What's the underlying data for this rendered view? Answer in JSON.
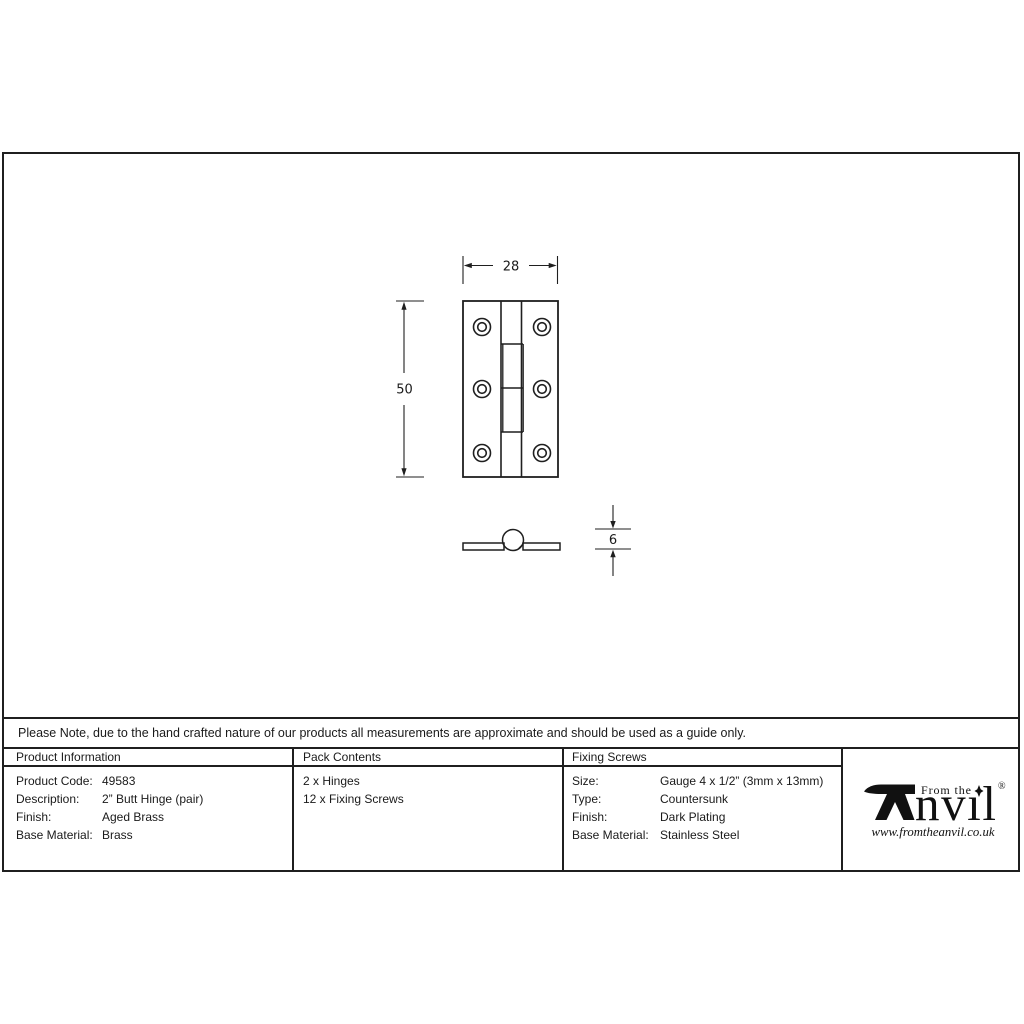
{
  "note": "Please Note, due to the hand crafted nature of our products all measurements are approximate and should be used as a guide only.",
  "drawing": {
    "width_label": "28",
    "height_label": "50",
    "thickness_label": "6"
  },
  "table": {
    "product_information": {
      "header": "Product Information",
      "rows": [
        {
          "label": "Product Code:",
          "value": "49583"
        },
        {
          "label": "Description:",
          "value": "2” Butt Hinge (pair)"
        },
        {
          "label": "Finish:",
          "value": "Aged Brass"
        },
        {
          "label": "Base Material:",
          "value": "Brass"
        }
      ]
    },
    "pack_contents": {
      "header": "Pack Contents",
      "items": [
        "2 x Hinges",
        "12 x Fixing Screws"
      ]
    },
    "fixing_screws": {
      "header": "Fixing Screws",
      "rows": [
        {
          "label": "Size:",
          "value": "Gauge 4 x 1/2” (3mm x 13mm)"
        },
        {
          "label": "Type:",
          "value": "Countersunk"
        },
        {
          "label": "Finish:",
          "value": "Dark Plating"
        },
        {
          "label": "Base Material:",
          "value": "Stainless Steel"
        }
      ]
    }
  },
  "logo": {
    "tagline": "From the",
    "name_rest": "nvıl",
    "registered": "®",
    "website": "www.fromtheanvil.co.uk"
  },
  "colors": {
    "line": "#1f1f1f",
    "text": "#1a1a1a",
    "background": "#ffffff"
  }
}
